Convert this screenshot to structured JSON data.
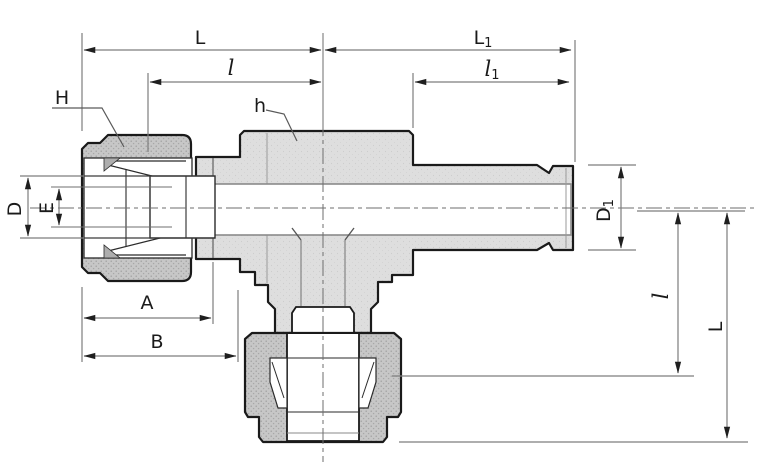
{
  "dimensions": {
    "top": {
      "L": "L",
      "L1": {
        "main": "L",
        "sub": "1"
      },
      "l": "l",
      "l1": {
        "main": "l",
        "sub": "1"
      }
    },
    "left": {
      "H": "H",
      "D": "D",
      "E": "E"
    },
    "center": {
      "h": "h"
    },
    "bottom": {
      "A": "A",
      "B": "B"
    },
    "right": {
      "D1": {
        "main": "D",
        "sub": "1"
      },
      "l": "l",
      "L": "L"
    }
  },
  "colors": {
    "background": "#ffffff",
    "body_fill": "#dedede",
    "nut_fill": "#c6c6c6",
    "outline": "#1a1a1a",
    "dimension_lines": "#7d7d7d",
    "label_text": "#1a1a1a"
  }
}
